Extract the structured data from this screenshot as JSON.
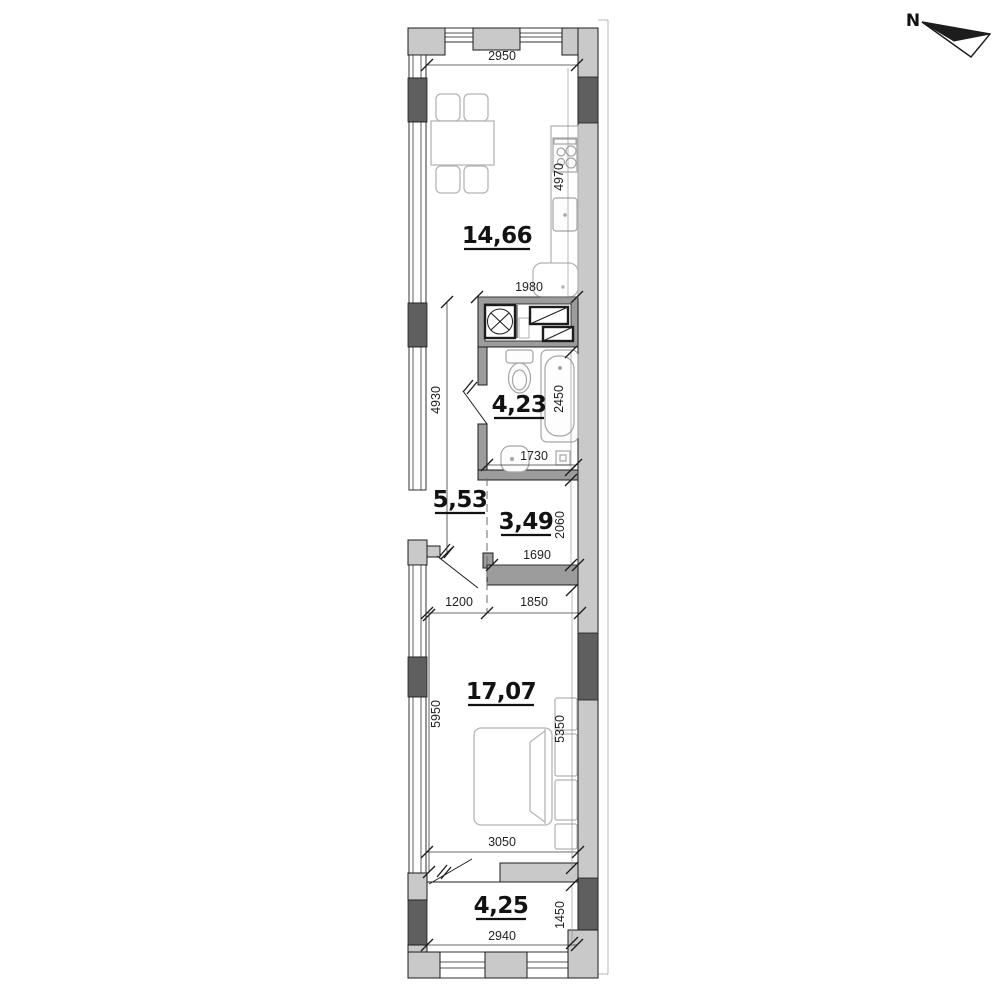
{
  "compass": {
    "label": "N"
  },
  "rooms": {
    "kitchen_living": {
      "area": "14,66"
    },
    "bathroom": {
      "area": "4,23"
    },
    "hallway": {
      "area": "5,53"
    },
    "wardrobe": {
      "area": "3,49"
    },
    "bedroom": {
      "area": "17,07"
    },
    "balcony": {
      "area": "4,25"
    }
  },
  "dimensions_mm": {
    "kitchen_width_top": "2950",
    "kitchen_depth": "4970",
    "kitchen_width_bottom": "1980",
    "hallway_depth": "4930",
    "bathroom_depth": "2450",
    "bathroom_width": "1730",
    "wardrobe_depth": "2060",
    "wardrobe_width": "1690",
    "hallway_width": "1200",
    "wardrobe_width_bottom": "1850",
    "bedroom_depth_left": "5950",
    "bedroom_depth_right": "5350",
    "bedroom_width": "3050",
    "balcony_width": "2940",
    "balcony_depth": "1450"
  },
  "colors": {
    "wall_light": "#c9c9c9",
    "wall_dark": "#5f5f5f",
    "wall_part": "#9c9c9c",
    "line": "#1c1c1c",
    "furniture": "#b5b5b5",
    "background": "#ffffff"
  }
}
